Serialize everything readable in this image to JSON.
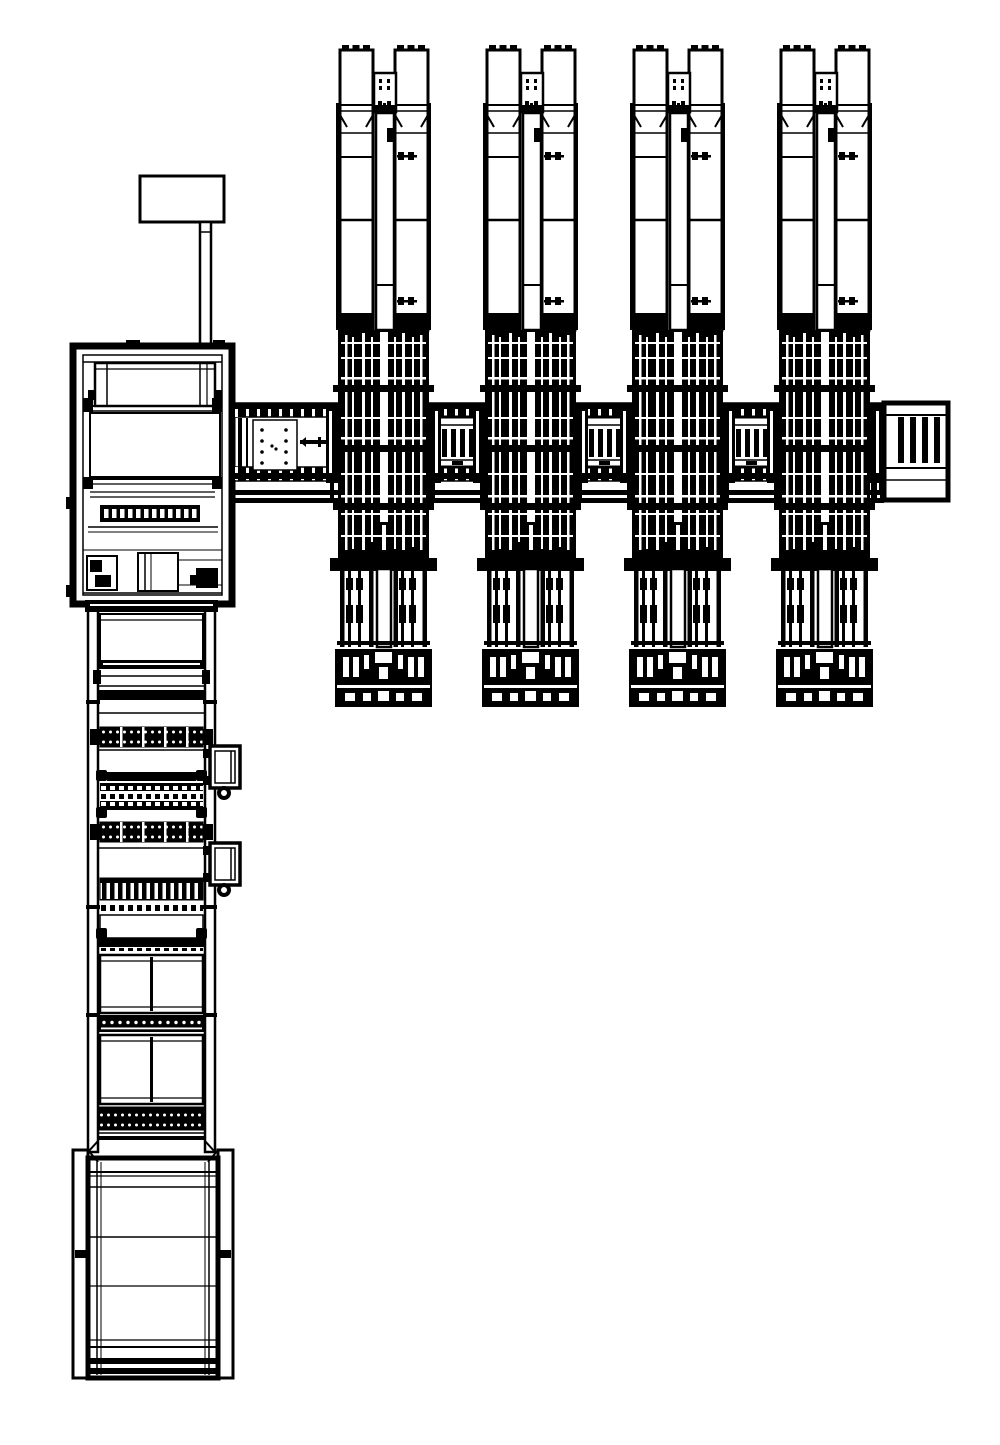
{
  "meta": {
    "title": "CAD plan-view line drawing of a processing line with four twin-column stations",
    "background_color": "#ffffff",
    "line_color": "#000000",
    "canvas": {
      "width": 1000,
      "height": 1445
    }
  },
  "stations": {
    "count": 4,
    "x_positions": [
      337,
      484,
      631,
      778
    ],
    "top_y": 45,
    "unit_width": 93,
    "unit_height": 667
  },
  "transfer_conveyor": {
    "x_start": 228,
    "x_end": 948,
    "top_rail_y": 403,
    "bottom_rail_y": 467,
    "rail_height": 14,
    "lower_bar_y": 490,
    "infill_box_x": [
      434,
      581,
      728
    ],
    "infill_box_y": 403,
    "dotted_plate": {
      "x": 253,
      "y": 420,
      "w": 44,
      "h": 50,
      "dot_count": 10
    },
    "end_frame": {
      "x": 884,
      "y": 403,
      "w": 64,
      "h": 97,
      "slat_count": 4
    }
  },
  "operator_station": {
    "monitor": {
      "x": 140,
      "y": 176,
      "w": 84,
      "h": 46
    },
    "pole": {
      "x": 200,
      "y": 222,
      "w": 11,
      "h": 124
    },
    "cabinet": {
      "x": 73,
      "y": 346,
      "w": 159,
      "h": 258
    },
    "comb_strip": {
      "x": 100,
      "y": 505,
      "w": 100,
      "h": 17,
      "slot_count": 12
    }
  },
  "process_line": {
    "left_rail_x": 88,
    "right_rail_x": 205,
    "rail_width": 10,
    "y_start": 604,
    "y_end": 1152,
    "comb_band_y": [
      727,
      822
    ],
    "side_unit_y": [
      746,
      843
    ],
    "teeth_band_y": 878,
    "dash_row_y": 903,
    "window_panels": [
      {
        "y": 955,
        "h": 58
      },
      {
        "y": 1035,
        "h": 69
      }
    ],
    "dot_band_y": [
      1015
    ],
    "tall_dot_band_y": 1107
  },
  "end_cabinet": {
    "x": 73,
    "y": 1150,
    "w": 160,
    "h": 230
  }
}
